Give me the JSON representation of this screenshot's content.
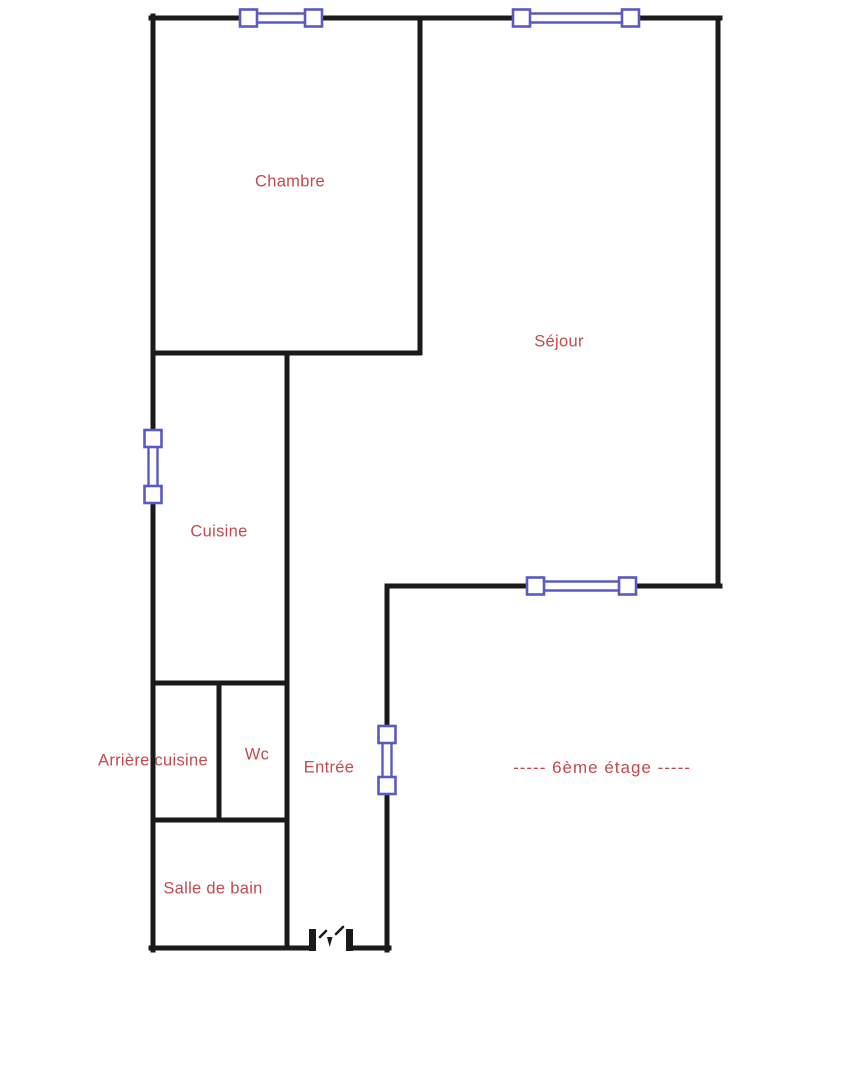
{
  "plan": {
    "type": "apartment-floor-plan",
    "floor_label": "-----  6ème étage  -----",
    "rooms": [
      {
        "id": "chambre",
        "label": "Chambre"
      },
      {
        "id": "sejour",
        "label": "Séjour"
      },
      {
        "id": "cuisine",
        "label": "Cuisine"
      },
      {
        "id": "arriere-cuisine",
        "label": "Arrière cuisine"
      },
      {
        "id": "wc",
        "label": "Wc"
      },
      {
        "id": "entree",
        "label": "Entrée"
      },
      {
        "id": "salle-de-bain",
        "label": "Salle de bain"
      }
    ],
    "symbols": {
      "window_count": 5,
      "door_count": 1
    },
    "colors": {
      "wall": "#1a1a1a",
      "window": "#5a5ac3",
      "label": "#c5494d",
      "background": "#ffffff"
    }
  }
}
